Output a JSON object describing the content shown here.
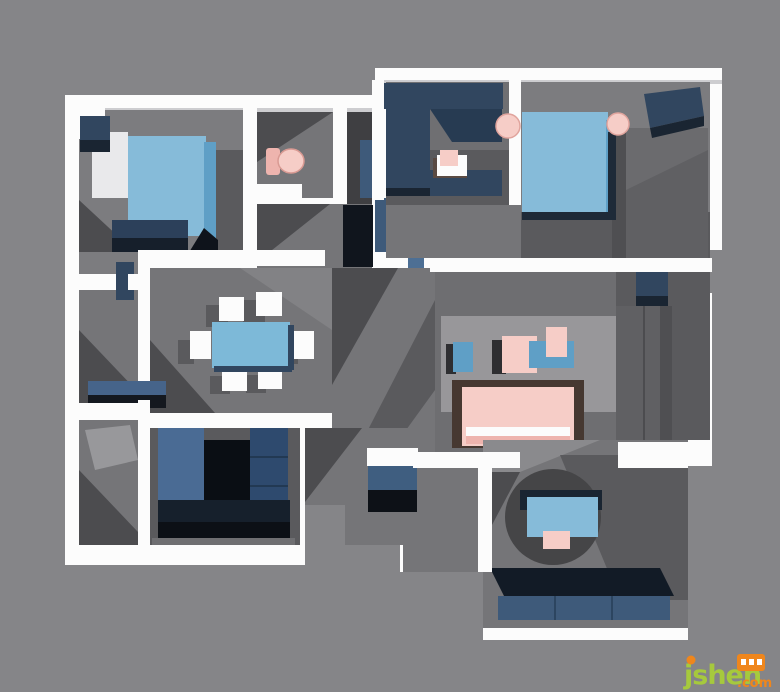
{
  "watermark": {
    "site": "jsheh",
    "tld": ".com",
    "badge_glyph_count": 3
  },
  "palette": {
    "bg": "#858588",
    "wall": "#fcfcfc",
    "wallShade": "#cdcdd0",
    "floorA": "#7c7c7f",
    "floorB": "#757578",
    "floorC": "#5a5a5d",
    "floorD": "#3f3f42",
    "shadowA": "#4c4c4f",
    "shadowB": "#5a5a5d",
    "rug": "#98979a",
    "circleRug": "#454547",
    "navy": "#31465f",
    "navyLight": "#3e5a7a",
    "navyDark": "#1a2532",
    "navyBlack": "#0e131b",
    "slate": "#4a6b94",
    "blue": "#86bbd9",
    "blueDeep": "#5f9fc6",
    "pink": "#f6cdc7",
    "pinkDeep": "#eeb4ae",
    "grayCab": "#606063",
    "grayCabDark": "#4f4f52",
    "brown": "#463831",
    "wmGreen": "#a6c93d",
    "wmOrange": "#ef861c"
  },
  "scene": {
    "type": "3d-floorplan-render",
    "rooms": [
      {
        "name": "bedroom-top-left",
        "furniture": [
          "nightstand",
          "wardrobe-panel",
          "double-bed",
          "foot-bench"
        ]
      },
      {
        "name": "bathroom",
        "furniture": [
          "toilet",
          "shower-area"
        ]
      },
      {
        "name": "hallway",
        "furniture": [
          "tall-cabinet",
          "slate-panel",
          "blue-stool",
          "shoe-cabinet"
        ]
      },
      {
        "name": "study-room",
        "furniture": [
          "corner-sofa",
          "small-desk",
          "pink-chair"
        ]
      },
      {
        "name": "master-bedroom",
        "furniture": [
          "double-bed",
          "round-stool-left",
          "round-stool-right",
          "bench",
          "wardrobe"
        ]
      },
      {
        "name": "dining-room",
        "furniture": [
          "dining-table",
          "chair",
          "chair",
          "chair",
          "chair",
          "chair",
          "chair",
          "sideboard"
        ]
      },
      {
        "name": "kitchen",
        "furniture": [
          "u-shaped-counter"
        ]
      },
      {
        "name": "living-room",
        "furniture": [
          "area-rug",
          "side-table",
          "coffee-table-set",
          "sofa",
          "tv-cabinet"
        ]
      },
      {
        "name": "balcony-bottom-right",
        "furniture": [
          "round-rug",
          "desk",
          "chair",
          "daybed"
        ]
      },
      {
        "name": "left-storage-balcony",
        "furniture": [
          "sideboard"
        ]
      }
    ]
  }
}
